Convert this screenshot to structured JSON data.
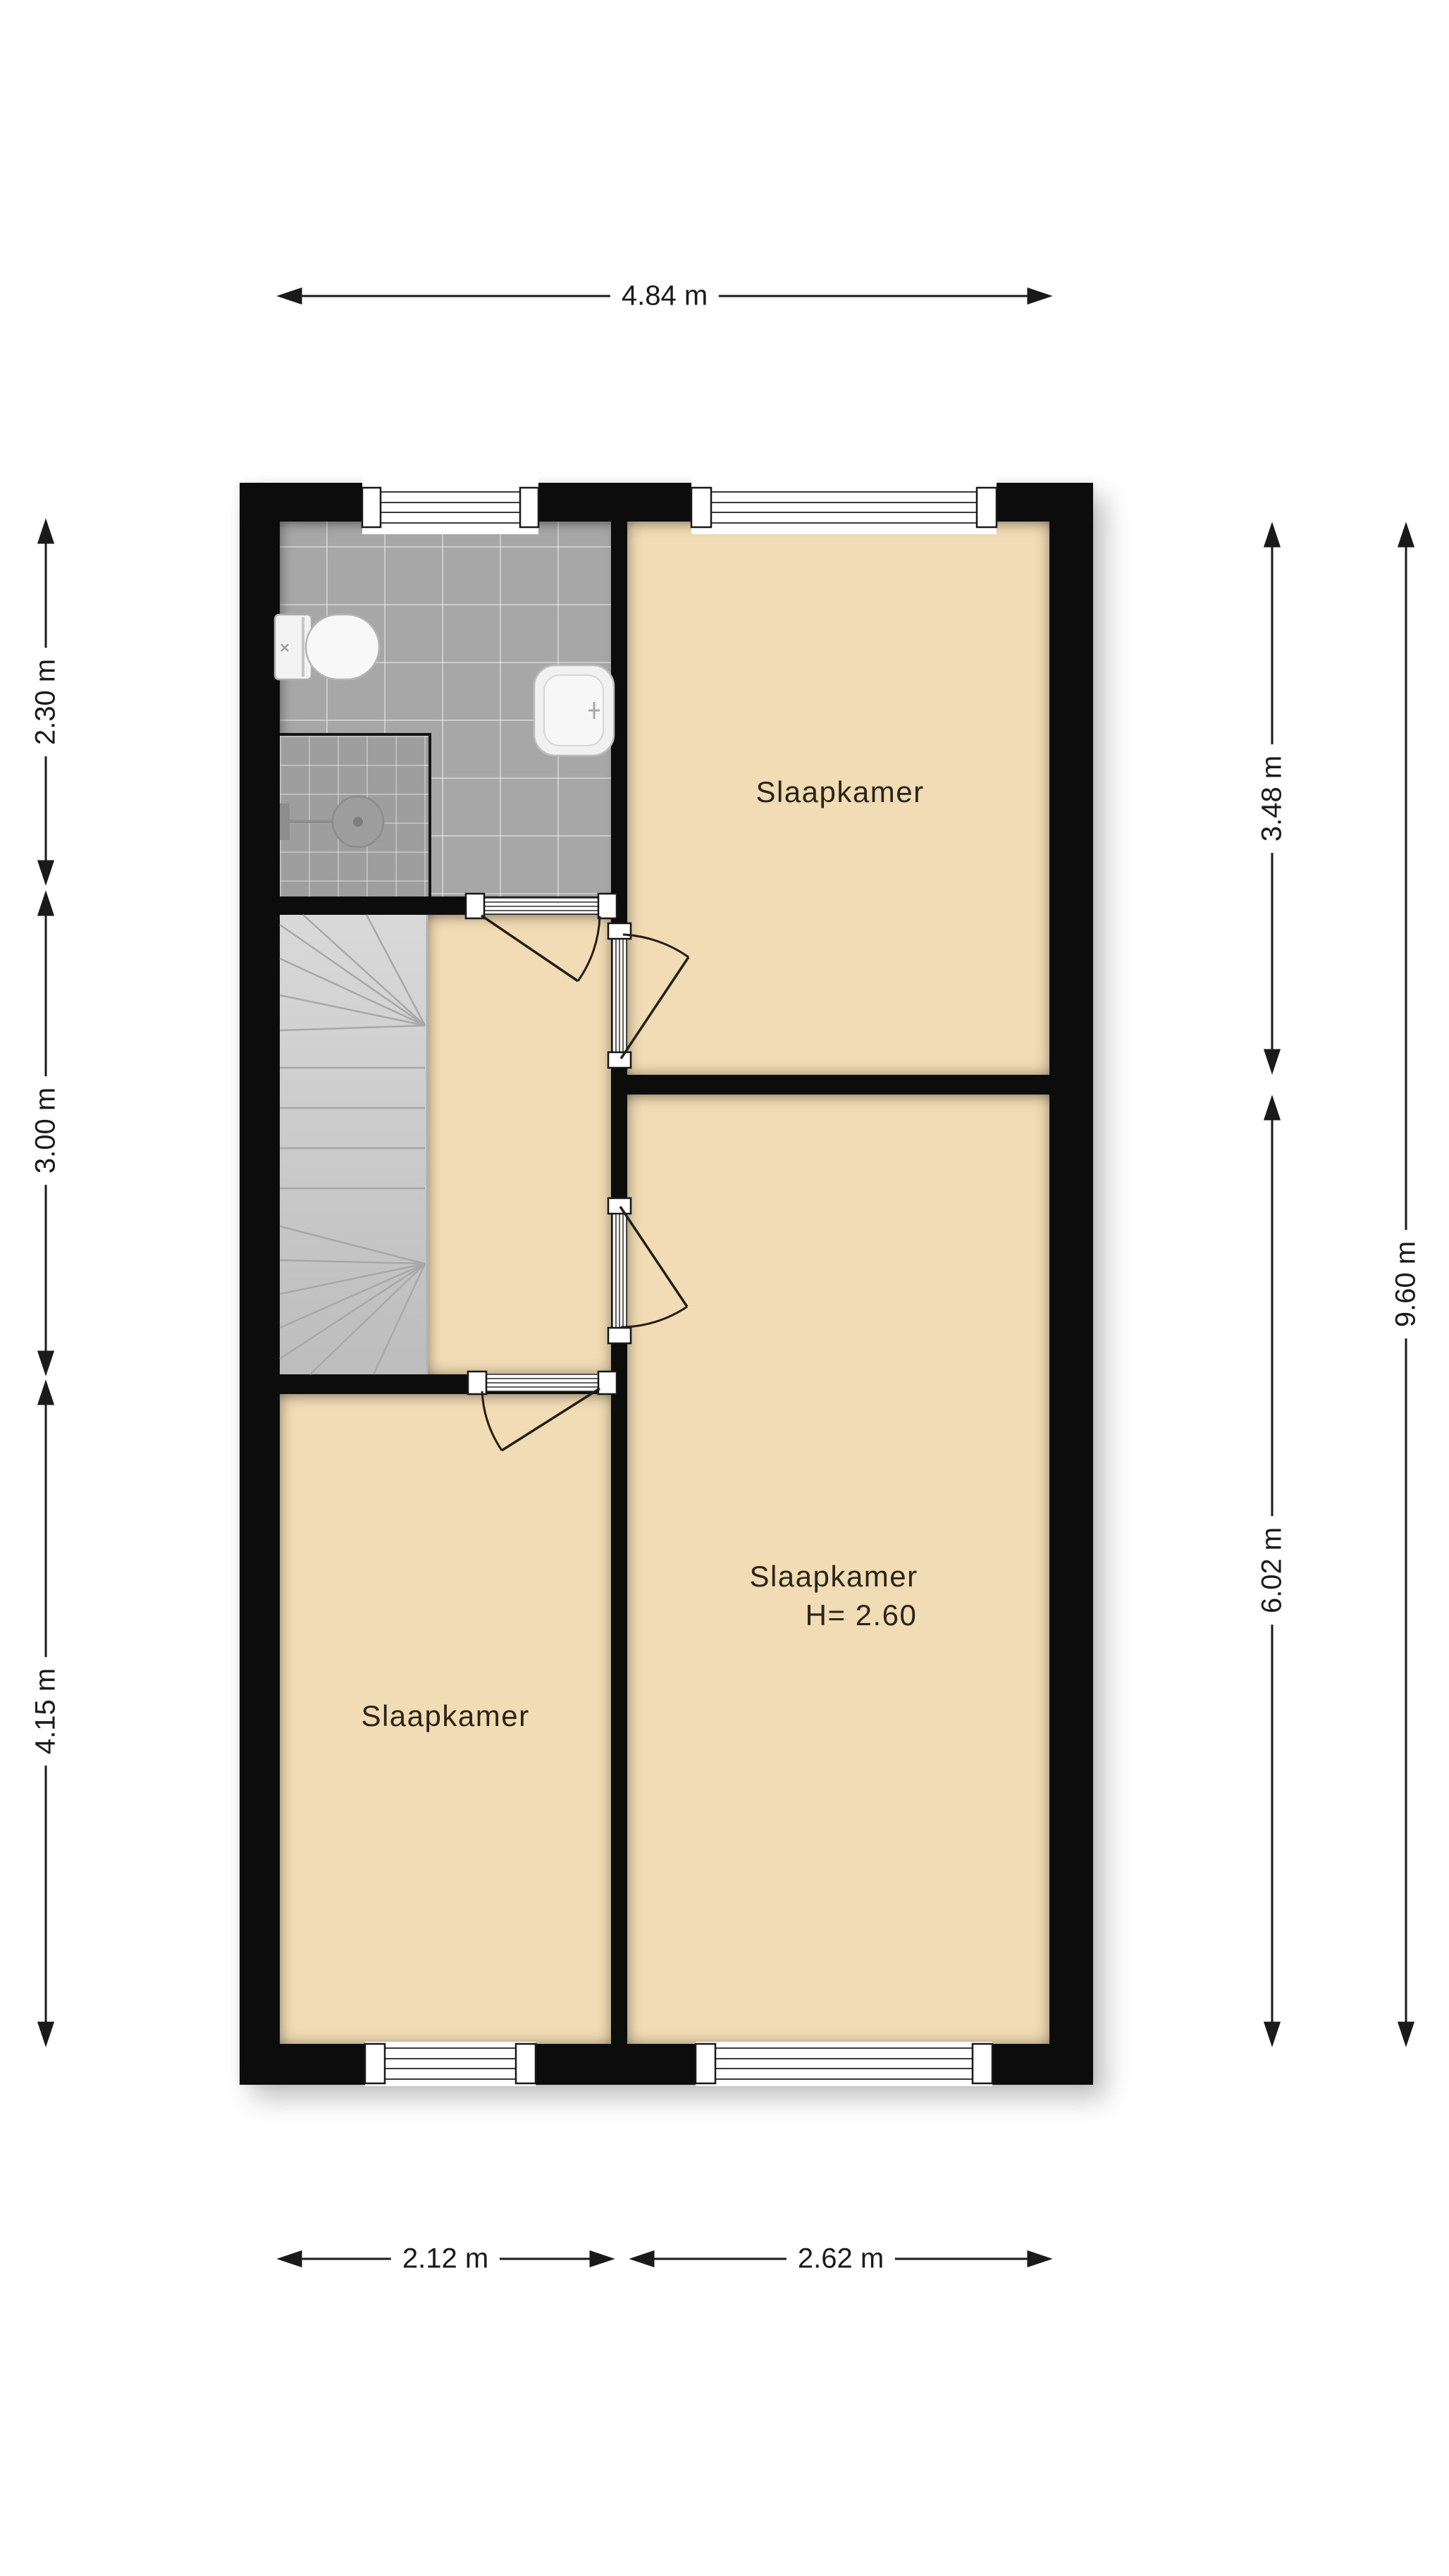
{
  "dimensions": {
    "top": "4.84 m",
    "bottom": [
      "2.12 m",
      "2.62 m"
    ],
    "left": [
      "2.30 m",
      "3.00 m",
      "4.15 m"
    ],
    "right_inner": [
      "3.48 m",
      "6.02 m"
    ],
    "right_outer": "9.60 m"
  },
  "rooms": {
    "bedroom_top_right": {
      "label": "Slaapkamer"
    },
    "bedroom_bottom_right": {
      "label": "Slaapkamer",
      "height_note": "H= 2.60"
    },
    "bedroom_bottom_left": {
      "label": "Slaapkamer"
    }
  },
  "icons": {
    "toilet": "toilet-icon",
    "sink": "sink-icon",
    "shower": "shower-head-icon",
    "staircase": "staircase-icon",
    "window": "window-symbol",
    "door": "door-swing-symbol"
  },
  "colors": {
    "background": "#FFFFFF",
    "wall": "#0C0C0C",
    "room_fill": "#F2DCB5",
    "bathroom_tile": "#A7A7A7",
    "tile_joint": "#E0E0E0",
    "stairs": "#CCCCCC",
    "dimension_line": "#1A1A1A"
  }
}
